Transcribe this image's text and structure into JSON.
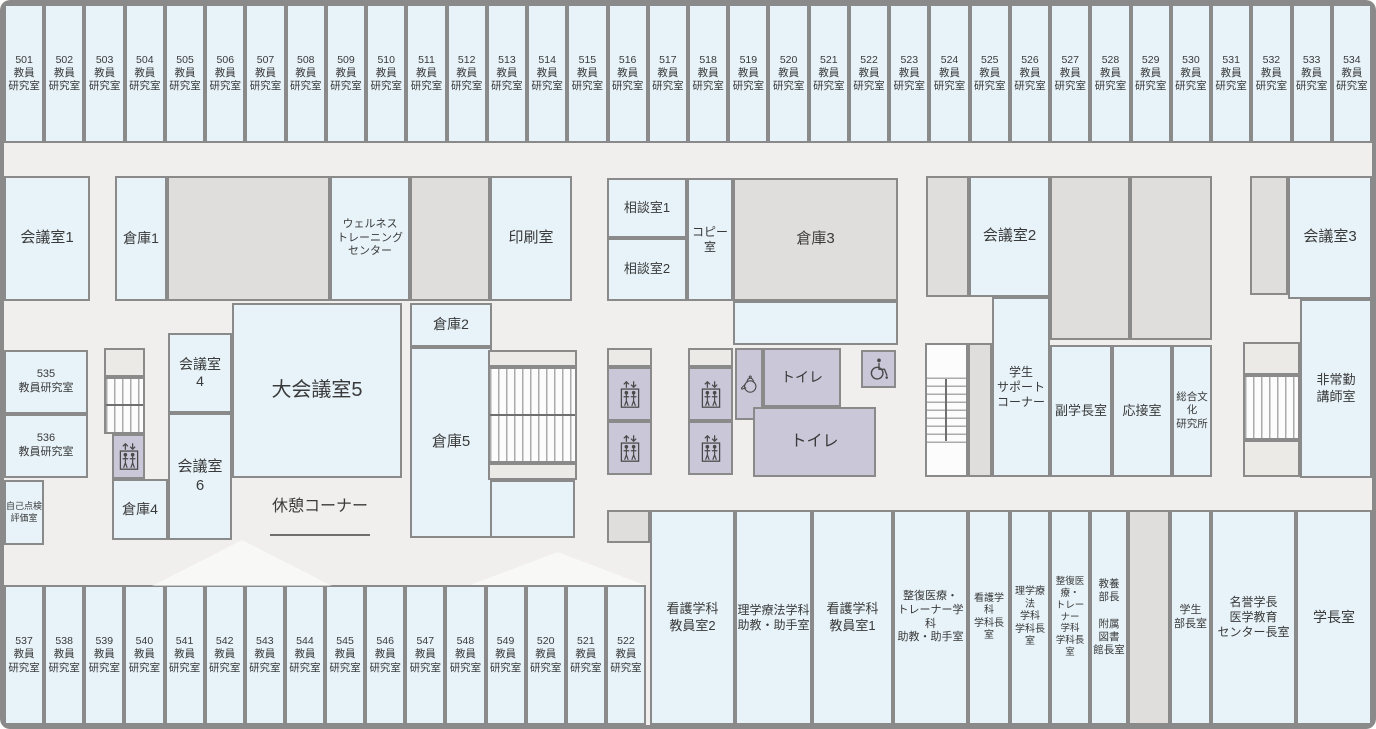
{
  "colors": {
    "background": "#f0efed",
    "room_blue": "#e7f3f9",
    "room_gray": "#e0dedd",
    "facility_purple": "#c9c7d8",
    "landing_gray": "#eceae7",
    "wall_border": "#8a8a8a",
    "text": "#3a3a3a"
  },
  "top_band": {
    "suffix": "教員\n研究室",
    "y": 4,
    "height": 139,
    "x_start": 4,
    "x_end": 1372,
    "numbers": [
      "501",
      "502",
      "503",
      "504",
      "505",
      "506",
      "507",
      "508",
      "509",
      "510",
      "511",
      "512",
      "513",
      "514",
      "515",
      "516",
      "517",
      "518",
      "519",
      "520",
      "521",
      "522",
      "523",
      "524",
      "525",
      "526",
      "527",
      "528",
      "529",
      "530",
      "531",
      "532",
      "533",
      "534"
    ]
  },
  "bottom_band": {
    "suffix": "教員\n研究室",
    "y": 585,
    "height": 140,
    "x_start": 4,
    "x_end": 646,
    "numbers": [
      "537",
      "538",
      "539",
      "540",
      "541",
      "542",
      "543",
      "544",
      "545",
      "546",
      "547",
      "548",
      "549",
      "520",
      "521",
      "522"
    ]
  },
  "rooms": [
    {
      "n": "meeting-room-1",
      "l": "会議室1",
      "t": "b",
      "x": 4,
      "y": 176,
      "w": 86,
      "h": 125,
      "f": 15
    },
    {
      "n": "storage-1",
      "l": "倉庫1",
      "t": "b",
      "x": 115,
      "y": 176,
      "w": 52,
      "h": 125,
      "f": 14
    },
    {
      "n": "unlabeled-gray-a",
      "t": "g",
      "x": 167,
      "y": 176,
      "w": 163,
      "h": 125
    },
    {
      "n": "wellness-training-center",
      "l": "ウェルネス\nトレーニング\nセンター",
      "t": "b",
      "x": 330,
      "y": 176,
      "w": 80,
      "h": 125,
      "f": 11
    },
    {
      "n": "unlabeled-gray-b",
      "t": "g",
      "x": 410,
      "y": 176,
      "w": 80,
      "h": 125
    },
    {
      "n": "print-room",
      "l": "印刷室",
      "t": "b",
      "x": 490,
      "y": 176,
      "w": 82,
      "h": 125,
      "f": 15
    },
    {
      "n": "consultation-room-1",
      "l": "相談室1",
      "t": "b",
      "x": 607,
      "y": 178,
      "w": 80,
      "h": 60,
      "f": 13
    },
    {
      "n": "consultation-room-2",
      "l": "相談室2",
      "t": "b",
      "x": 607,
      "y": 238,
      "w": 80,
      "h": 63,
      "f": 13
    },
    {
      "n": "copy-room",
      "l": "コピー\n室",
      "t": "b",
      "x": 687,
      "y": 178,
      "w": 46,
      "h": 123,
      "f": 12
    },
    {
      "n": "storage-3",
      "l": "倉庫3",
      "t": "g",
      "x": 733,
      "y": 178,
      "w": 165,
      "h": 123,
      "f": 15
    },
    {
      "n": "storage-3-annex",
      "t": "b",
      "x": 733,
      "y": 301,
      "w": 165,
      "h": 44
    },
    {
      "n": "meeting-room-2-gray",
      "t": "g",
      "x": 926,
      "y": 176,
      "w": 43,
      "h": 121
    },
    {
      "n": "meeting-room-2",
      "l": "会議室2",
      "t": "b",
      "x": 969,
      "y": 176,
      "w": 81,
      "h": 121,
      "f": 15
    },
    {
      "n": "unlabeled-gray-c",
      "t": "g",
      "x": 1050,
      "y": 176,
      "w": 80,
      "h": 164
    },
    {
      "n": "unlabeled-gray-d",
      "t": "g",
      "x": 1130,
      "y": 176,
      "w": 82,
      "h": 164
    },
    {
      "n": "meeting-room-3-gray",
      "t": "g",
      "x": 1250,
      "y": 176,
      "w": 38,
      "h": 119
    },
    {
      "n": "meeting-room-3",
      "l": "会議室3",
      "t": "b",
      "x": 1288,
      "y": 176,
      "w": 84,
      "h": 123,
      "f": 15
    },
    {
      "n": "room-535",
      "l": "535\n教員研究室",
      "t": "b",
      "x": 4,
      "y": 350,
      "w": 84,
      "h": 64,
      "f": 11
    },
    {
      "n": "room-536",
      "l": "536\n教員研究室",
      "t": "b",
      "x": 4,
      "y": 414,
      "w": 84,
      "h": 64,
      "f": 11
    },
    {
      "n": "self-inspection-evaluation-room",
      "l": "自己点検\n評価室",
      "t": "b",
      "x": 4,
      "y": 480,
      "w": 40,
      "h": 65,
      "f": 9
    },
    {
      "n": "stair-landing-left",
      "t": "ld",
      "x": 104,
      "y": 348,
      "w": 41,
      "h": 29
    },
    {
      "n": "stairs-left",
      "t": "sv",
      "x": 104,
      "y": 377,
      "w": 41,
      "h": 57
    },
    {
      "n": "stairs-left-midline",
      "t": "ln",
      "x": 106,
      "y": 404,
      "w": 37,
      "h": 2
    },
    {
      "n": "elevator-left",
      "t": "p",
      "x": 112,
      "y": 434,
      "w": 33,
      "h": 45,
      "i": "elevator-icon"
    },
    {
      "n": "storage-4",
      "l": "倉庫4",
      "t": "b",
      "x": 112,
      "y": 479,
      "w": 56,
      "h": 61,
      "f": 14
    },
    {
      "n": "meeting-room-4",
      "l": "会議室\n4",
      "t": "b",
      "x": 168,
      "y": 333,
      "w": 64,
      "h": 80,
      "f": 14
    },
    {
      "n": "meeting-room-6",
      "l": "会議室\n6",
      "t": "b",
      "x": 168,
      "y": 413,
      "w": 64,
      "h": 127,
      "f": 15
    },
    {
      "n": "large-meeting-room-5",
      "l": "大会議室5",
      "t": "b",
      "x": 232,
      "y": 303,
      "w": 170,
      "h": 175,
      "f": 20
    },
    {
      "n": "storage-2",
      "l": "倉庫2",
      "t": "b",
      "x": 410,
      "y": 303,
      "w": 82,
      "h": 44,
      "f": 14
    },
    {
      "n": "storage-5",
      "l": "倉庫5",
      "t": "b",
      "x": 410,
      "y": 347,
      "w": 82,
      "h": 191,
      "f": 15
    },
    {
      "n": "storage-5-annex",
      "t": "b",
      "x": 490,
      "y": 480,
      "w": 85,
      "h": 58
    },
    {
      "n": "stair-landing-center-top",
      "t": "ld",
      "x": 488,
      "y": 350,
      "w": 89,
      "h": 17
    },
    {
      "n": "stairs-center",
      "t": "sv",
      "x": 488,
      "y": 367,
      "w": 89,
      "h": 96
    },
    {
      "n": "stairs-center-midline",
      "t": "ln",
      "x": 490,
      "y": 414,
      "w": 85,
      "h": 2
    },
    {
      "n": "stair-landing-center-bottom",
      "t": "ld",
      "x": 488,
      "y": 463,
      "w": 89,
      "h": 17
    },
    {
      "n": "rest-corner-label",
      "l": "休憩コーナー",
      "t": "lb",
      "x": 240,
      "y": 488,
      "w": 160,
      "h": 38,
      "f": 16
    },
    {
      "n": "rest-corner-underline",
      "t": "ln",
      "x": 270,
      "y": 534,
      "w": 100,
      "h": 2
    },
    {
      "n": "elevator-landing-a",
      "t": "ld",
      "x": 607,
      "y": 348,
      "w": 45,
      "h": 19
    },
    {
      "n": "elevator-a1",
      "t": "p",
      "x": 607,
      "y": 367,
      "w": 45,
      "h": 54,
      "i": "elevator-icon"
    },
    {
      "n": "elevator-a2",
      "t": "p",
      "x": 607,
      "y": 421,
      "w": 45,
      "h": 54,
      "i": "elevator-icon"
    },
    {
      "n": "elevator-landing-b",
      "t": "ld",
      "x": 688,
      "y": 348,
      "w": 45,
      "h": 19
    },
    {
      "n": "elevator-b1",
      "t": "p",
      "x": 688,
      "y": 367,
      "w": 45,
      "h": 54,
      "i": "elevator-icon"
    },
    {
      "n": "elevator-b2",
      "t": "p",
      "x": 688,
      "y": 421,
      "w": 45,
      "h": 54,
      "i": "elevator-icon"
    },
    {
      "n": "kettle-room",
      "t": "p",
      "x": 735,
      "y": 348,
      "w": 28,
      "h": 72,
      "i": "kettle-icon"
    },
    {
      "n": "toilet-upper",
      "l": "トイレ",
      "t": "p",
      "x": 763,
      "y": 348,
      "w": 78,
      "h": 59,
      "f": 14
    },
    {
      "n": "toilet-lower",
      "l": "トイレ",
      "t": "p",
      "x": 753,
      "y": 407,
      "w": 123,
      "h": 70,
      "f": 16
    },
    {
      "n": "accessible-toilet",
      "t": "p",
      "x": 861,
      "y": 350,
      "w": 35,
      "h": 38,
      "i": "wheelchair-icon"
    },
    {
      "n": "stairs-right-middle-block",
      "t": "w",
      "x": 925,
      "y": 343,
      "w": 43,
      "h": 134
    },
    {
      "n": "stairs-right-middle",
      "t": "sh",
      "x": 927,
      "y": 377,
      "w": 39,
      "h": 66
    },
    {
      "n": "stairs-right-middle-midline",
      "t": "ln",
      "x": 945,
      "y": 379,
      "w": 2,
      "h": 62
    },
    {
      "n": "gray-strip-right",
      "t": "g",
      "x": 968,
      "y": 343,
      "w": 24,
      "h": 134
    },
    {
      "n": "student-support-corner",
      "l": "学生\nサポート\nコーナー",
      "t": "b",
      "x": 992,
      "y": 297,
      "w": 58,
      "h": 180,
      "f": 12
    },
    {
      "n": "vice-president-room",
      "l": "副学長室",
      "t": "b",
      "x": 1050,
      "y": 345,
      "w": 62,
      "h": 132,
      "f": 13
    },
    {
      "n": "reception-room",
      "l": "応接室",
      "t": "b",
      "x": 1112,
      "y": 345,
      "w": 60,
      "h": 132,
      "f": 13
    },
    {
      "n": "general-culture-research-institute",
      "l": "総合文化\n研究所",
      "t": "b",
      "x": 1172,
      "y": 345,
      "w": 40,
      "h": 132,
      "f": 10.5
    },
    {
      "n": "stair-landing-right-top",
      "t": "ld",
      "x": 1243,
      "y": 342,
      "w": 57,
      "h": 33
    },
    {
      "n": "stairs-right",
      "t": "sv",
      "x": 1243,
      "y": 375,
      "w": 57,
      "h": 65
    },
    {
      "n": "stair-landing-right-bottom",
      "t": "ld",
      "x": 1243,
      "y": 440,
      "w": 57,
      "h": 37
    },
    {
      "n": "part-time-lecturer-room",
      "l": "非常勤\n講師室",
      "t": "b",
      "x": 1300,
      "y": 299,
      "w": 72,
      "h": 179,
      "f": 13
    },
    {
      "n": "gray-square-bottom",
      "t": "g",
      "x": 607,
      "y": 510,
      "w": 43,
      "h": 33
    },
    {
      "n": "nursing-faculty-room-2",
      "l": "看護学科\n教員室2",
      "t": "b",
      "x": 650,
      "y": 510,
      "w": 85,
      "h": 215,
      "f": 13
    },
    {
      "n": "pt-assistant-room",
      "l": "理学療法学科\n助教・助手室",
      "t": "b",
      "x": 735,
      "y": 510,
      "w": 77,
      "h": 215,
      "f": 12
    },
    {
      "n": "nursing-faculty-room-1",
      "l": "看護学科\n教員室1",
      "t": "b",
      "x": 812,
      "y": 510,
      "w": 81,
      "h": 215,
      "f": 13
    },
    {
      "n": "judo-trainer-assistant-room",
      "l": "整復医療・\nトレーナー学科\n助教・助手室",
      "t": "b",
      "x": 893,
      "y": 510,
      "w": 75,
      "h": 215,
      "f": 11
    },
    {
      "n": "nursing-dept-head-room",
      "l": "看護学科\n学科長室",
      "t": "b",
      "x": 968,
      "y": 510,
      "w": 42,
      "h": 215,
      "f": 10
    },
    {
      "n": "pt-dept-head-room",
      "l": "理学療法\n学科\n学科長室",
      "t": "b",
      "x": 1010,
      "y": 510,
      "w": 40,
      "h": 215,
      "f": 10
    },
    {
      "n": "judo-trainer-dept-head-room",
      "l": "整復医療・\nトレーナー\n学科\n学科長室",
      "t": "b",
      "x": 1050,
      "y": 510,
      "w": 40,
      "h": 215,
      "f": 9.5
    },
    {
      "n": "liberal-arts-head-library-head-room",
      "l": "教養\n部長\n\n附属\n図書\n館長室",
      "t": "b",
      "x": 1090,
      "y": 510,
      "w": 38,
      "h": 215,
      "f": 10.5
    },
    {
      "n": "gray-column-bottom",
      "t": "g",
      "x": 1128,
      "y": 510,
      "w": 42,
      "h": 215
    },
    {
      "n": "student-affairs-head-room",
      "l": "学生\n部長室",
      "t": "b",
      "x": 1170,
      "y": 510,
      "w": 41,
      "h": 215,
      "f": 11
    },
    {
      "n": "honorary-president-medical-education-center-head-room",
      "l": "名誉学長\n医学教育\nセンター長室",
      "t": "b",
      "x": 1211,
      "y": 510,
      "w": 85,
      "h": 215,
      "f": 12
    },
    {
      "n": "president-room",
      "l": "学長室",
      "t": "b",
      "x": 1296,
      "y": 510,
      "w": 76,
      "h": 215,
      "f": 14
    },
    {
      "n": "triangle-decor-1",
      "t": "tr",
      "x": 152,
      "y": 540,
      "w": 180,
      "h": 46
    },
    {
      "n": "triangle-decor-2",
      "t": "tr",
      "x": 470,
      "y": 552,
      "w": 175,
      "h": 33
    }
  ]
}
